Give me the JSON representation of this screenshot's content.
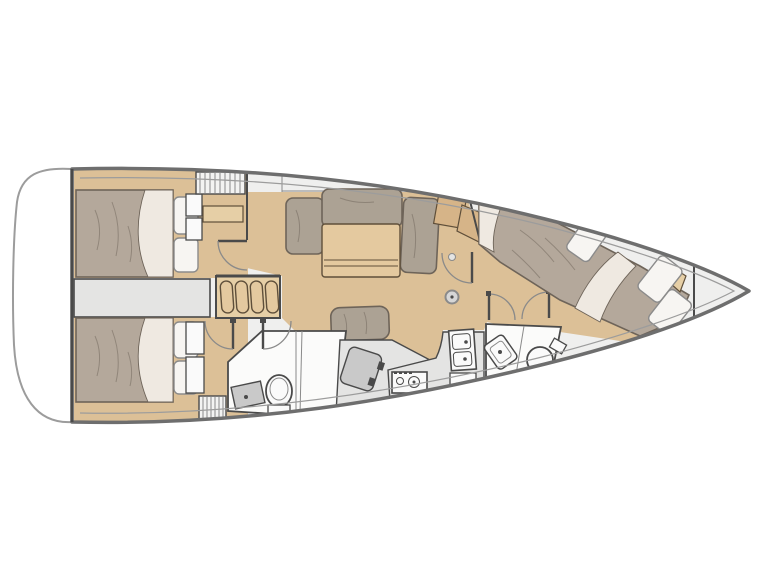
{
  "figure": {
    "kind": "sailing-yacht-interior-floorplan",
    "orientation": "bow-right",
    "rooms": [
      "aft-port-cabin",
      "aft-starboard-cabin",
      "companionway",
      "salon-dinette",
      "nav-station",
      "aft-head",
      "galley",
      "forward-head",
      "forward-cabin",
      "bow-locker",
      "swim-platform"
    ]
  },
  "colors": {
    "page_bg": "#ffffff",
    "hull_stroke": "#6e6e6e",
    "hull_inner_stroke": "#9c9c9c",
    "deck_fill": "#efefee",
    "platform_fill": "#ffffff",
    "wall_dark": "#4a4a4a",
    "line_mid": "#8a8a8a",
    "floor_wood": "#dcc097",
    "wood_light": "#e6cfa6",
    "wood_mid": "#d6b488",
    "wood_dark_stroke": "#5f4f3a",
    "bed_fill": "#b4a89b",
    "bed_stroke": "#6e6459",
    "sheet_fill": "#efe9e1",
    "pillow_fill": "#f7f5f2",
    "pillow_stroke": "#8b8b8b",
    "cushion_fill": "#aca294",
    "table_fill": "#e4c99f",
    "gray_item": "#c9c9c9",
    "gray_panel": "#e4e4e3",
    "bath_fill": "#fbfbfa",
    "white_item": "#fafafa",
    "hatch_fill": "#f3f3f2",
    "mast_fill": "#d6d6d6"
  }
}
